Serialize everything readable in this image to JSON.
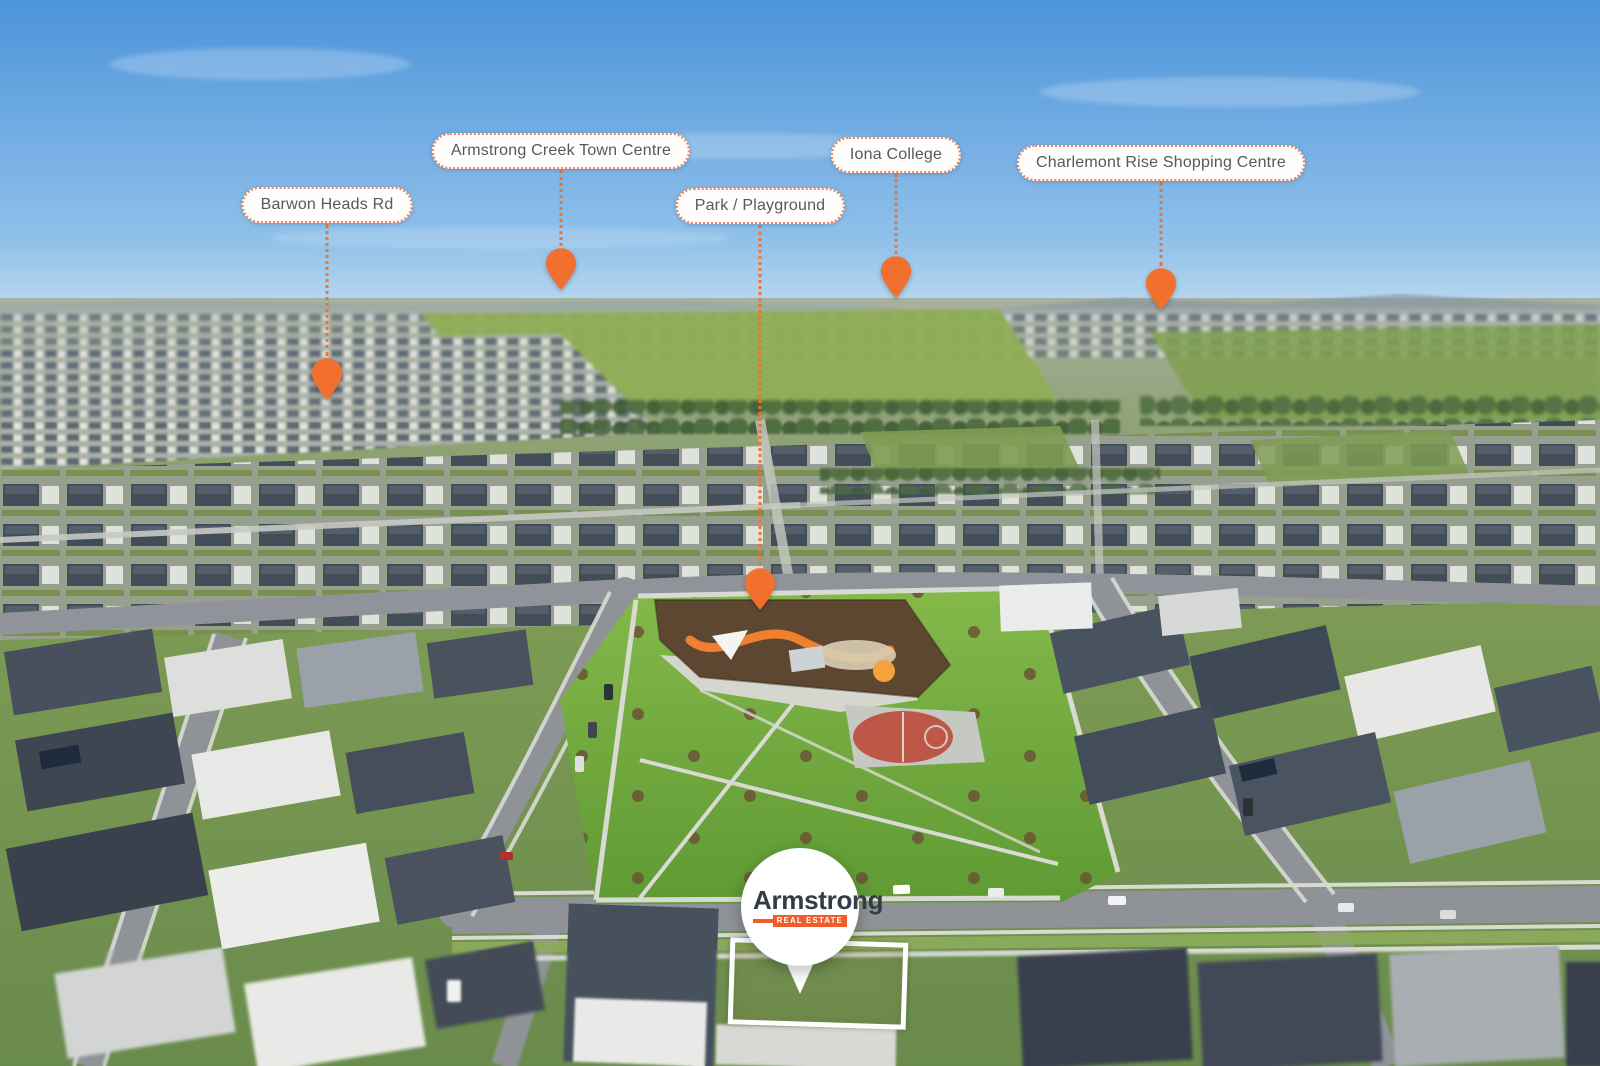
{
  "callouts": [
    {
      "id": "armstrong-creek-town-centre",
      "label": "Armstrong Creek Town Centre"
    },
    {
      "id": "barwon-heads-rd",
      "label": "Barwon Heads Rd"
    },
    {
      "id": "park-playground",
      "label": "Park / Playground"
    },
    {
      "id": "iona-college",
      "label": "Iona College"
    },
    {
      "id": "charlemont-rise-shopping-centre",
      "label": "Charlemont Rise Shopping Centre"
    }
  ],
  "brand_marker": {
    "name": "Armstrong",
    "tagline": "REAL ESTATE"
  },
  "colors": {
    "pin-orange": "#F2702D",
    "callout-border": "#F0835A",
    "callout-bg": "#FFFEFC",
    "callout-text": "#55585D",
    "logo-text": "#333B44",
    "logo-orange": "#F05C2B",
    "lot-outline": "#FFFFFF"
  }
}
